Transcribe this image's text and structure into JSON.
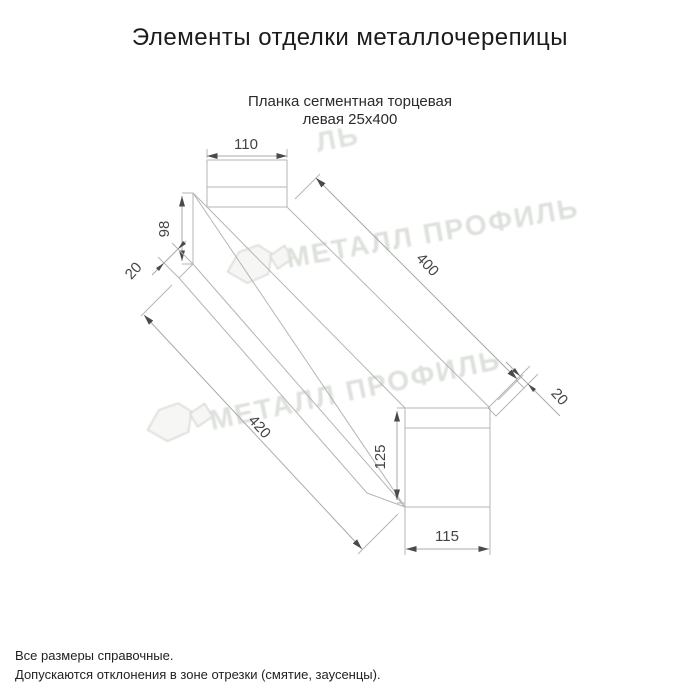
{
  "title": "Элементы отделки металлочерепицы",
  "subtitle": {
    "line1": "Планка сегментная торцевая",
    "line2": "левая 25х400"
  },
  "drawing": {
    "name": "Планка сегментная торцевая левая 25х400",
    "dimensions": {
      "top_flange_width": "110",
      "left_end_height": "98",
      "left_hem": "20",
      "length_top": "400",
      "length_bottom": "420",
      "right_hem": "20",
      "right_end_height": "125",
      "bottom_flange_width": "115"
    }
  },
  "watermark": {
    "text": "МЕТАЛЛ ПРОФИЛЬ",
    "fragment": "ЛЬ",
    "color": "#d7dcd5"
  },
  "footer": {
    "line1": "Все размеры справочные.",
    "line2": "Допускаются отклонения в зоне отрезки (смятие, заусенцы)."
  },
  "colors": {
    "background": "#ffffff",
    "drawing_line": "#b5b5b5",
    "dimension_text": "#444444",
    "arrow": "#4a4a4a",
    "title_text": "#1b1b1b"
  }
}
